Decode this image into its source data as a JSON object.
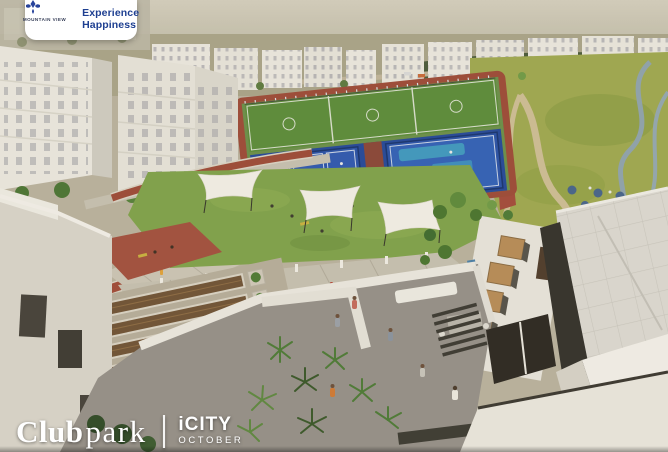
{
  "branding": {
    "logo_name": "MOUNTAIN VIEW",
    "tagline_line1": "Experience",
    "tagline_line2": "Happiness",
    "brand_blue": "#1e3f91",
    "card_bg": "#ffffff"
  },
  "footer": {
    "project_bold": "Club",
    "project_light": "park",
    "divider": "|",
    "location_name": "iCITY",
    "location_sub": "OCTOBER",
    "text_color": "#ffffff"
  },
  "scene": {
    "caption": "Aerial render of a residential club park: blue padel courts, green football pitches, brick-red jogging track, lawns shaded by white sail canopies, paved promenades with planters, rooftop terraces with people and palms, white apartment buildings on the horizon and a landscaped park with streams on the right",
    "features": [
      "residential-buildings",
      "padel-courts",
      "football-pitches",
      "running-track",
      "central-lawn",
      "shade-sails",
      "promenade",
      "planter-plaza",
      "playground",
      "rooftop-terrace",
      "landscaped-park",
      "roof-skylights",
      "lake"
    ],
    "palette": {
      "sky_haze": "#cbc6b5",
      "building_white": "#e9e6df",
      "court_blue": "#2a52a8",
      "court_accent": "#3f98c0",
      "field_green": "#5b8c3a",
      "track_red": "#9c4a38",
      "lawn_green": "#7fa24b",
      "park_green": "#9fa851",
      "water": "#8fa3ad",
      "paving": "#c6c0b1",
      "roof_white": "#dcd9d2",
      "skylight_tan": "#b78c58",
      "plant_dark": "#49742f"
    }
  }
}
